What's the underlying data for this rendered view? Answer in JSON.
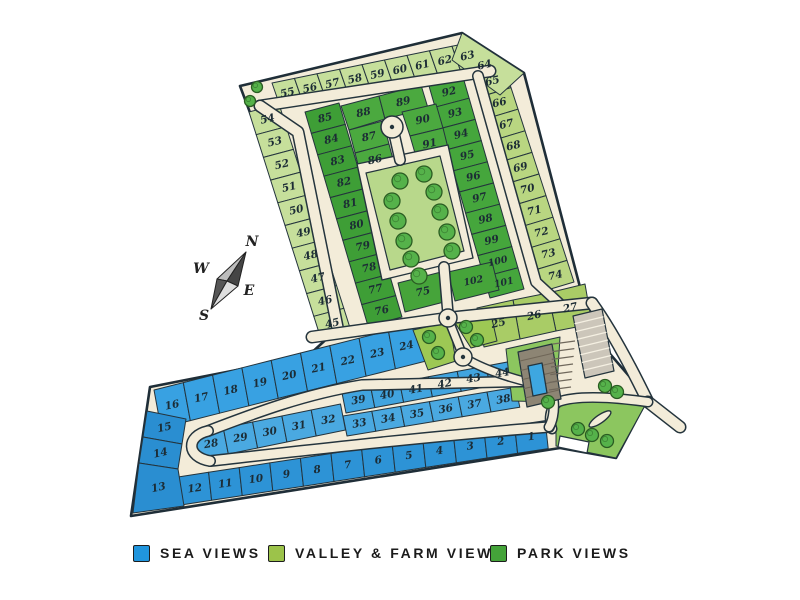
{
  "legend": {
    "items": [
      {
        "name": "sea",
        "label": "SEA VIEWS",
        "color": "#2095dd"
      },
      {
        "name": "valley",
        "label": "VALLEY & FARM VIEWS",
        "color": "#9cc34a"
      },
      {
        "name": "park",
        "label": "PARK VIEWS",
        "color": "#44a339"
      }
    ]
  },
  "compass": {
    "n": "N",
    "w": "W",
    "e": "E",
    "s": "S"
  },
  "map": {
    "road_color": "#f3ecd9",
    "outline_color": "#1f2e38",
    "lot_stroke": "#24343d",
    "label_color": "#1c2c35",
    "lawn_color": "#8cc65f",
    "park_lawn_color": "#b8d88b",
    "tree_fill": "#55b24a",
    "tree_stroke": "#2a5c22",
    "site": [
      [
        240,
        86
      ],
      [
        462,
        33
      ],
      [
        524,
        73
      ],
      [
        592,
        333
      ],
      [
        648,
        398
      ],
      [
        616,
        458
      ],
      [
        560,
        448
      ],
      [
        131,
        516
      ],
      [
        150,
        387
      ],
      [
        308,
        356
      ],
      [
        333,
        333
      ]
    ],
    "rows": [
      {
        "name": "valley-top-row",
        "fill": "#c6df9b",
        "nums": [
          55,
          56,
          57,
          58,
          59,
          60,
          61,
          62,
          63
        ],
        "start": [
          272,
          83
        ],
        "step": [
          22.5,
          -4.6
        ],
        "depth": [
          8.5,
          24.5
        ],
        "angle": -13
      },
      {
        "name": "valley-west-column",
        "fill": "#c6df9b",
        "nums": [
          54,
          53,
          52,
          51,
          50,
          49,
          48,
          47,
          46,
          45
        ],
        "start": [
          249,
          112
        ],
        "step": [
          7.2,
          22.7
        ],
        "depth": [
          30,
          -8
        ],
        "angle": -13
      },
      {
        "name": "valley-east-column",
        "fill": "#b9d681",
        "nums": [
          65,
          66,
          67,
          68,
          69,
          70,
          71,
          72,
          73,
          74
        ],
        "start": [
          504,
          66
        ],
        "step": [
          7.0,
          21.6
        ],
        "depth": [
          -30,
          9
        ],
        "angle": -13
      },
      {
        "name": "park-west-column",
        "fill": "#3e9e36",
        "nums": [
          85,
          84,
          83,
          82,
          81,
          80,
          79,
          78,
          77,
          76
        ],
        "start": [
          305,
          112
        ],
        "step": [
          6.3,
          21.4
        ],
        "depth": [
          34,
          -9
        ],
        "angle": -13
      },
      {
        "name": "park-east-column",
        "fill": "#45a63c",
        "nums": [
          92,
          93,
          94,
          95,
          96,
          97,
          98,
          99,
          100,
          101
        ],
        "start": [
          463,
          77
        ],
        "step": [
          6.1,
          21.2
        ],
        "depth": [
          -34,
          9
        ],
        "angle": -13
      },
      {
        "name": "sea-north-row",
        "fill": "#38a1e2",
        "nums": [
          16,
          17,
          18,
          19,
          20,
          21,
          22,
          23,
          24
        ],
        "start": [
          154,
          390
        ],
        "step": [
          29.3,
          -7.4
        ],
        "depth": [
          7,
          38
        ],
        "angle": -12
      },
      {
        "name": "sea-inner-upper-row",
        "fill": "#41a4df",
        "nums": [
          39,
          40,
          41,
          42,
          43,
          44
        ],
        "start": [
          342,
          393
        ],
        "step": [
          28.8,
          -5.4
        ],
        "depth": [
          4,
          20
        ],
        "angle": -10
      },
      {
        "name": "sea-inner-lower-row",
        "fill": "#4aa9e1",
        "nums": [
          33,
          34,
          35,
          36,
          37,
          38
        ],
        "start": [
          343,
          416
        ],
        "step": [
          28.8,
          -4.8
        ],
        "depth": [
          4,
          20
        ],
        "angle": -10
      },
      {
        "name": "sea-inner-left-row",
        "fill": "#4aa9e1",
        "nums": [
          28,
          29,
          30,
          31,
          32
        ],
        "start": [
          194,
          434
        ],
        "step": [
          29.3,
          -6
        ],
        "depth": [
          5,
          26
        ],
        "angle": -10
      },
      {
        "name": "sea-south-row",
        "fill": "#2d93d6",
        "nums": [
          12,
          11,
          10,
          9,
          8,
          7,
          6,
          5,
          4,
          3,
          2,
          1
        ],
        "start": [
          178,
          477
        ],
        "step": [
          30.6,
          -4.7
        ],
        "depth": [
          3,
          28
        ],
        "angle": -8
      }
    ],
    "lots": [
      {
        "n": 64,
        "fill": "#c6df9b",
        "poly": [
          [
            462,
            33
          ],
          [
            524,
            73
          ],
          [
            500,
            95
          ],
          [
            452,
            60
          ]
        ]
      },
      {
        "n": 27,
        "fill": "#a9cc66",
        "poly": [
          [
            548,
            293
          ],
          [
            585,
            284
          ],
          [
            592,
            324
          ],
          [
            556,
            331
          ]
        ]
      },
      {
        "n": 26,
        "fill": "#a9cc66",
        "poly": [
          [
            513,
            300
          ],
          [
            548,
            293
          ],
          [
            556,
            331
          ],
          [
            520,
            339
          ]
        ]
      },
      {
        "n": 25,
        "fill": "#a9cc66",
        "poly": [
          [
            477,
            308
          ],
          [
            513,
            300
          ],
          [
            520,
            339
          ],
          [
            484,
            347
          ]
        ]
      },
      {
        "n": 88,
        "fill": "#4ba93f",
        "poly": [
          [
            341,
            106
          ],
          [
            379,
            96
          ],
          [
            385,
            119
          ],
          [
            349,
            130
          ]
        ]
      },
      {
        "n": 89,
        "fill": "#4ba93f",
        "poly": [
          [
            379,
            96
          ],
          [
            421,
            85
          ],
          [
            428,
            108
          ],
          [
            385,
            119
          ]
        ]
      },
      {
        "n": 90,
        "fill": "#4ba93f",
        "poly": [
          [
            402,
            112
          ],
          [
            436,
            104
          ],
          [
            443,
            128
          ],
          [
            410,
            136
          ]
        ]
      },
      {
        "n": 91,
        "fill": "#4ba93f",
        "poly": [
          [
            410,
            136
          ],
          [
            443,
            128
          ],
          [
            449,
            152
          ],
          [
            417,
            160
          ]
        ]
      },
      {
        "n": 87,
        "fill": "#4ba93f",
        "poly": [
          [
            349,
            130
          ],
          [
            383,
            121
          ],
          [
            389,
            144
          ],
          [
            355,
            153
          ]
        ]
      },
      {
        "n": 86,
        "fill": "#4ba93f",
        "poly": [
          [
            355,
            153
          ],
          [
            389,
            144
          ],
          [
            395,
            167
          ],
          [
            361,
            176
          ]
        ]
      },
      {
        "n": 75,
        "fill": "#46a43a",
        "poly": [
          [
            398,
            283
          ],
          [
            441,
            272
          ],
          [
            448,
            301
          ],
          [
            405,
            312
          ]
        ]
      },
      {
        "n": 102,
        "fill": "#46a43a",
        "poly": [
          [
            448,
            272
          ],
          [
            492,
            262
          ],
          [
            499,
            290
          ],
          [
            455,
            301
          ]
        ]
      },
      {
        "n": 15,
        "fill": "#2a8ed1",
        "poly": [
          [
            147,
            411
          ],
          [
            186,
            419
          ],
          [
            182,
            444
          ],
          [
            143,
            437
          ]
        ]
      },
      {
        "n": 14,
        "fill": "#2a8ed1",
        "poly": [
          [
            143,
            437
          ],
          [
            182,
            444
          ],
          [
            178,
            469
          ],
          [
            139,
            463
          ]
        ]
      },
      {
        "n": 13,
        "fill": "#2a8ed1",
        "poly": [
          [
            139,
            463
          ],
          [
            178,
            469
          ],
          [
            184,
            506
          ],
          [
            133,
            513
          ]
        ]
      }
    ],
    "greenspaces": [
      {
        "poly": [
          [
            413,
            330
          ],
          [
            449,
            322
          ],
          [
            456,
            361
          ],
          [
            428,
            370
          ]
        ],
        "trees": [
          [
            429,
            337
          ],
          [
            438,
            353
          ]
        ]
      },
      {
        "poly": [
          [
            452,
            318
          ],
          [
            490,
            310
          ],
          [
            497,
            341
          ],
          [
            471,
            348
          ]
        ],
        "trees": [
          [
            466,
            327
          ],
          [
            477,
            340
          ]
        ]
      }
    ],
    "park": {
      "outer": [
        [
          357,
          164
        ],
        [
          448,
          145
        ],
        [
          473,
          258
        ],
        [
          382,
          280
        ]
      ],
      "lawn": [
        [
          366,
          173
        ],
        [
          440,
          156
        ],
        [
          464,
          251
        ],
        [
          390,
          270
        ]
      ],
      "trees": [
        [
          400,
          181
        ],
        [
          424,
          174
        ],
        [
          392,
          201
        ],
        [
          434,
          192
        ],
        [
          398,
          221
        ],
        [
          440,
          212
        ],
        [
          404,
          241
        ],
        [
          447,
          232
        ],
        [
          411,
          259
        ],
        [
          452,
          251
        ],
        [
          419,
          276
        ]
      ]
    },
    "roads": {
      "paths": [
        {
          "d": "M260,106 L490,71",
          "w": 13
        },
        {
          "d": "M260,106 L298,132 L338,330",
          "w": 13
        },
        {
          "d": "M478,76 L536,282 L562,306",
          "w": 12
        },
        {
          "d": "M312,337 L448,318 L592,303",
          "w": 13
        },
        {
          "d": "M592,303 C610,328 630,365 648,402",
          "w": 13
        },
        {
          "d": "M648,402 L680,427",
          "w": 13
        },
        {
          "d": "M648,402 C612,397 577,395 558,402 C549,409 549,420 552,429",
          "w": 11
        },
        {
          "d": "M208,431 C255,413 305,394 362,385 L545,381",
          "w": 12
        },
        {
          "d": "M210,461 C300,451 430,436 549,427",
          "w": 12
        },
        {
          "d": "M208,431 C186,436 186,457 210,461",
          "w": 12
        },
        {
          "d": "M545,381 C556,390 556,416 549,427",
          "w": 11
        },
        {
          "d": "M463,357 C482,369 512,379 540,385",
          "w": 10
        },
        {
          "d": "M444,267 L448,314",
          "w": 12
        },
        {
          "d": "M393,129 L400,160",
          "w": 12
        },
        {
          "d": "M449,321 L461,351",
          "w": 10
        }
      ],
      "circles": [
        {
          "name": "cul-de-sac",
          "cx": 392,
          "cy": 127,
          "r": 11
        },
        {
          "name": "roundabout",
          "cx": 448,
          "cy": 318,
          "r": 9
        },
        {
          "name": "roundabout",
          "cx": 463,
          "cy": 357,
          "r": 9
        }
      ]
    },
    "clubhouse": {
      "lawn": [
        [
          506,
          349
        ],
        [
          560,
          337
        ],
        [
          556,
          402
        ],
        [
          512,
          401
        ]
      ],
      "entry_lawn": [
        [
          556,
          402
        ],
        [
          648,
          400
        ],
        [
          616,
          458
        ],
        [
          556,
          446
        ]
      ],
      "building": [
        [
          518,
          352
        ],
        [
          552,
          344
        ],
        [
          561,
          399
        ],
        [
          527,
          407
        ]
      ],
      "pool": [
        [
          528,
          366
        ],
        [
          542,
          363
        ],
        [
          547,
          393
        ],
        [
          533,
          396
        ]
      ],
      "parking": [
        [
          573,
          316
        ],
        [
          602,
          309
        ],
        [
          614,
          371
        ],
        [
          585,
          378
        ]
      ],
      "stall_count": 8,
      "stripe_area": {
        "a": [
          553,
          344
        ],
        "b": [
          549,
          390
        ],
        "len": [
          22,
          -3
        ],
        "count": 7
      },
      "median": {
        "cx": 600,
        "cy": 419,
        "rx": 13,
        "ry": 4,
        "rot": -35
      },
      "gate": [
        [
          560,
          436
        ],
        [
          589,
          442
        ],
        [
          587,
          453
        ],
        [
          558,
          447
        ]
      ],
      "trees": [
        [
          548,
          402
        ],
        [
          605,
          386
        ],
        [
          617,
          392
        ],
        [
          578,
          429
        ],
        [
          592,
          435
        ],
        [
          607,
          441
        ]
      ]
    },
    "corner_trees": [
      [
        257,
        87
      ],
      [
        250,
        101
      ]
    ],
    "compass": {
      "tip_n": [
        246,
        252
      ],
      "tip_s": [
        211,
        309
      ],
      "vx_w": [
        217,
        279
      ],
      "vx_e": [
        238,
        286
      ],
      "center": [
        227,
        281
      ],
      "labels": {
        "n": [
          252,
          246
        ],
        "w": [
          201,
          273
        ],
        "e": [
          249,
          295
        ],
        "s": [
          204,
          320
        ]
      }
    }
  }
}
